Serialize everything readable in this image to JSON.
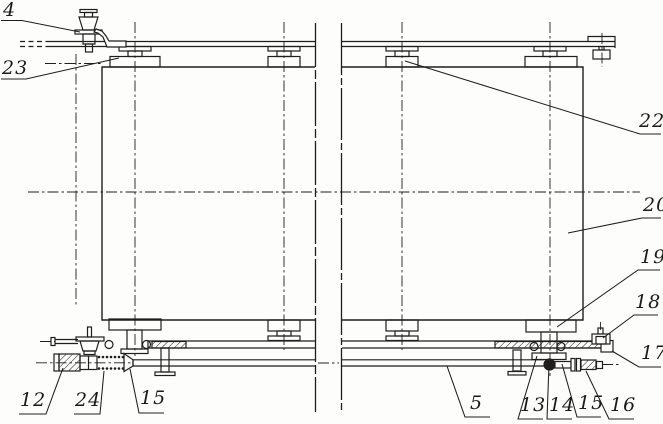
{
  "figure": {
    "type": "technical-drawing",
    "description_visible_text_only": true,
    "colors": {
      "background": "#fdfdfc",
      "line": "#1f1e1c"
    },
    "callouts": [
      {
        "label": "4"
      },
      {
        "label": "23"
      },
      {
        "label": "22"
      },
      {
        "label": "20"
      },
      {
        "label": "19"
      },
      {
        "label": "18"
      },
      {
        "label": "17"
      },
      {
        "label": "16"
      },
      {
        "label": "15"
      },
      {
        "label": "14"
      },
      {
        "label": "13"
      },
      {
        "label": "5"
      },
      {
        "label": "15"
      },
      {
        "label": "24"
      },
      {
        "label": "12"
      }
    ]
  }
}
